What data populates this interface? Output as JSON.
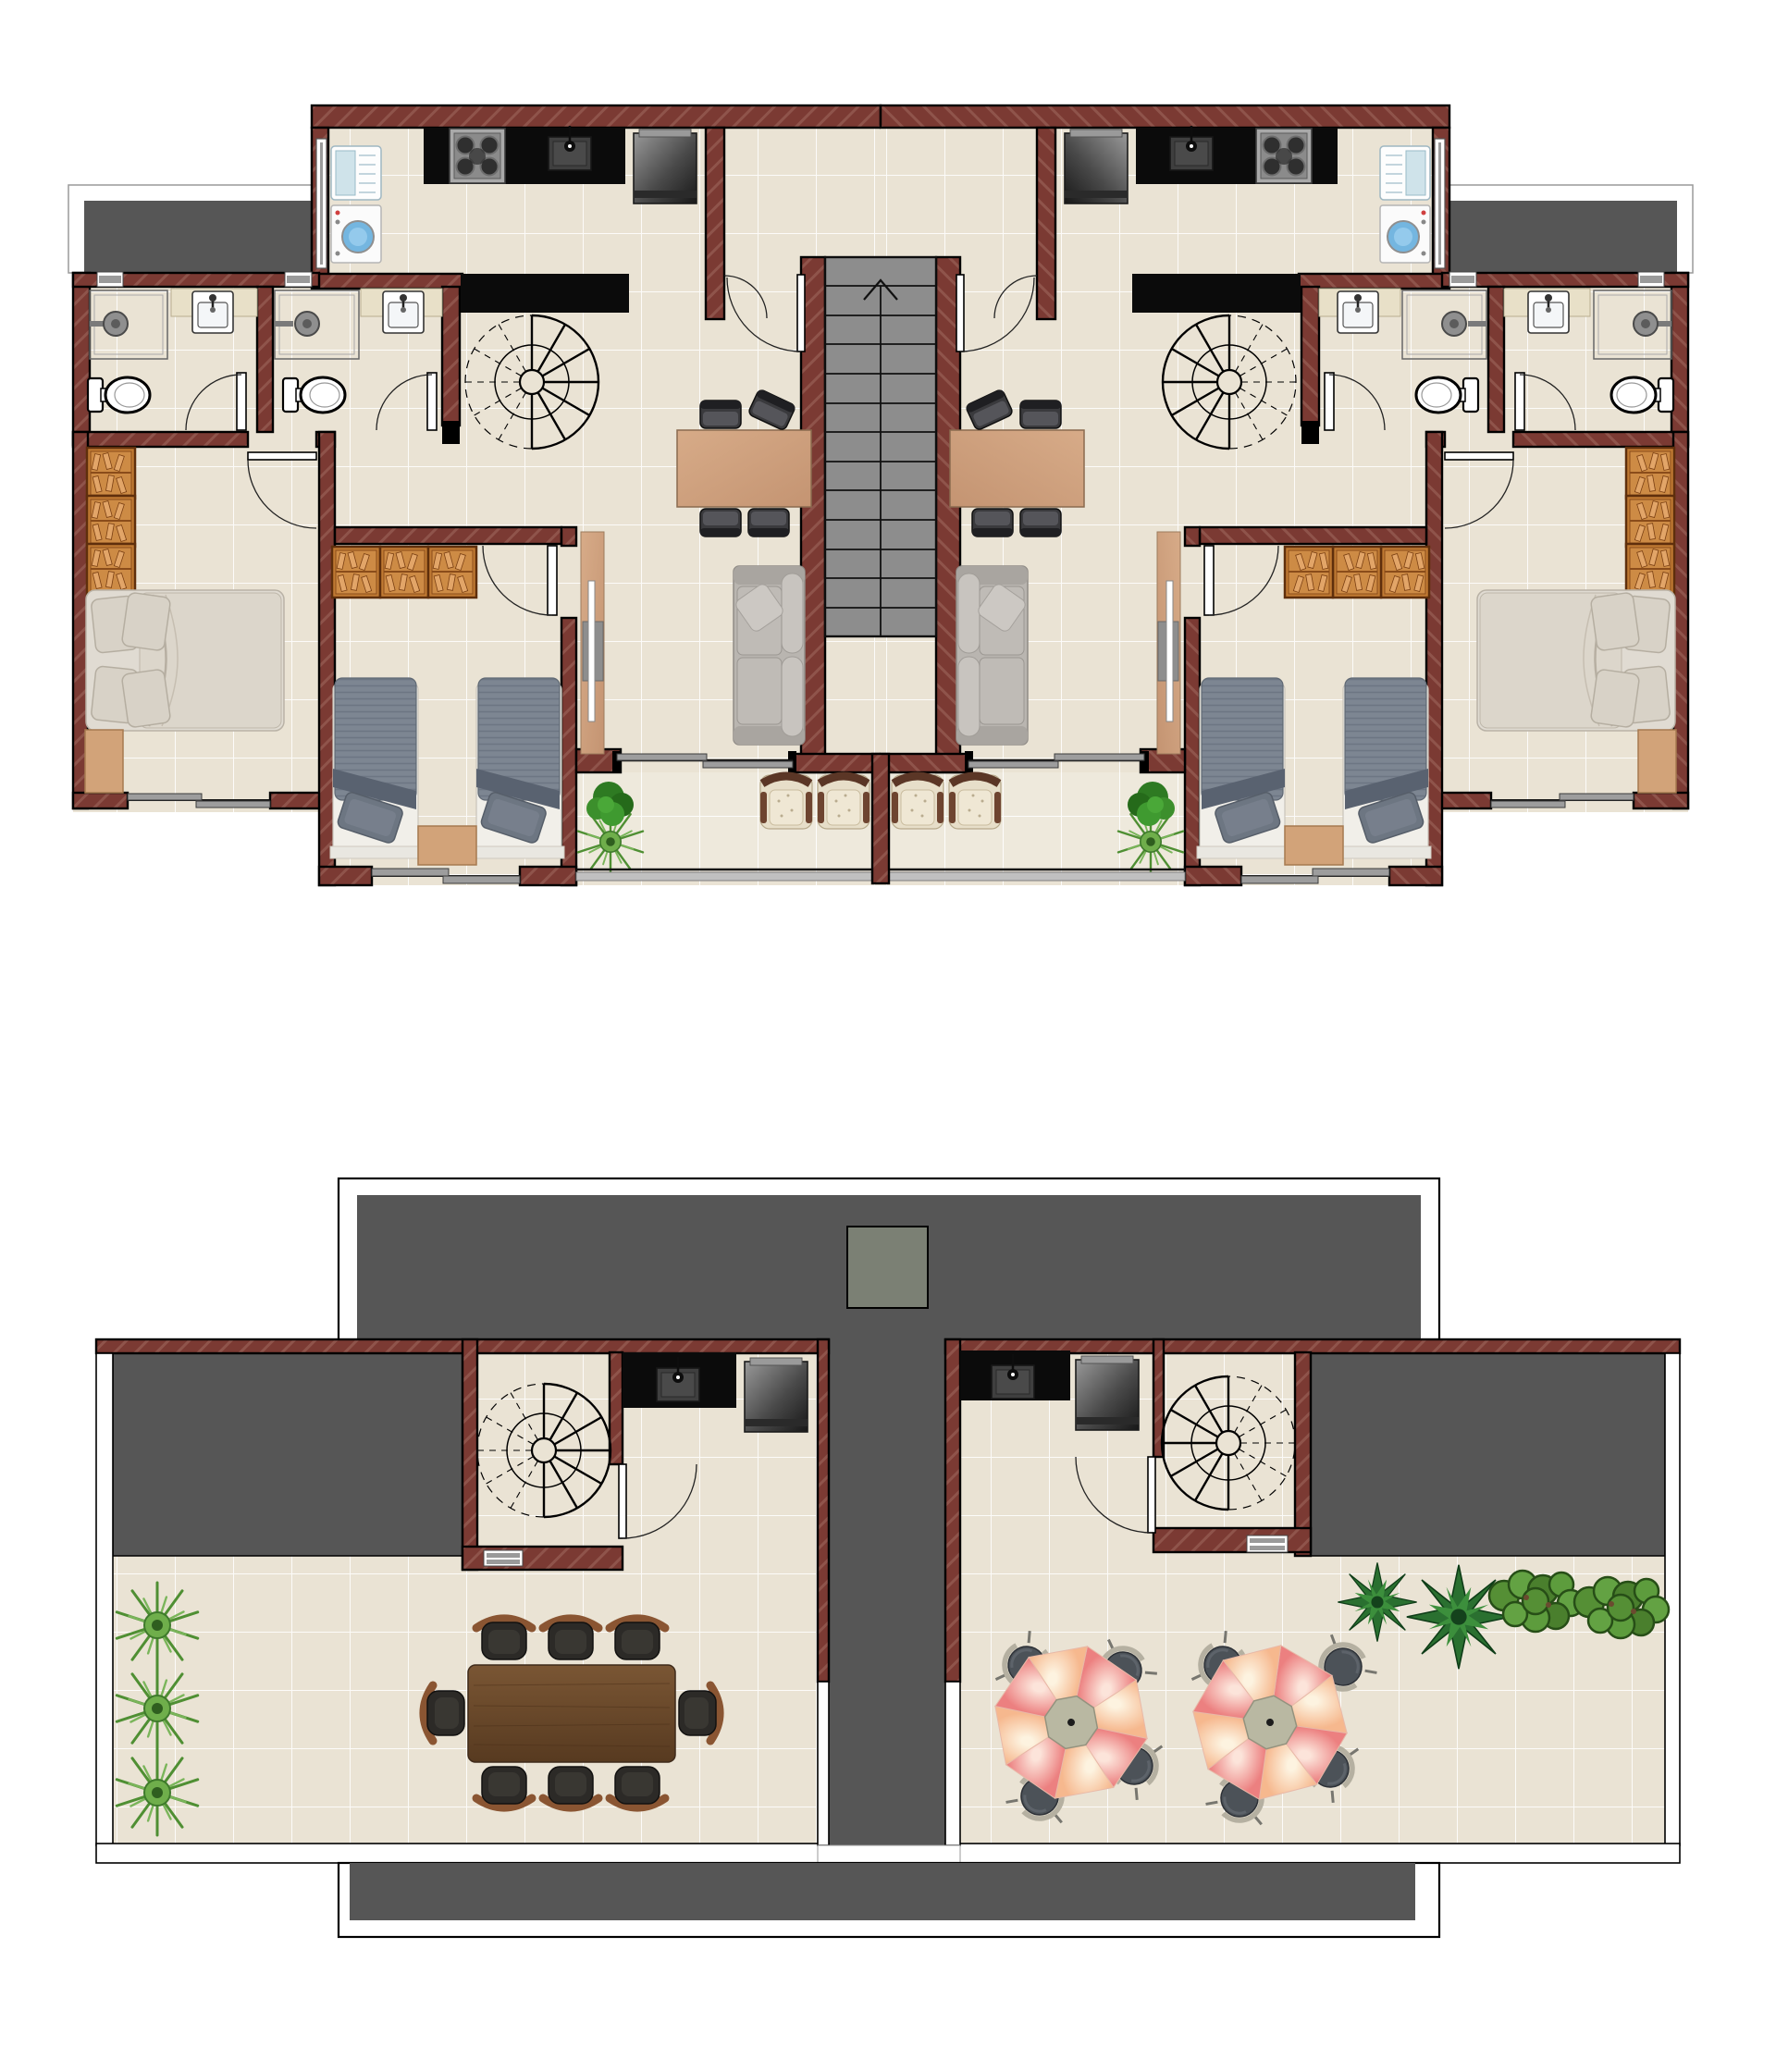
{
  "document": {
    "type": "architectural floor plan",
    "sheets": [
      "upper floor plan",
      "roof terrace plan"
    ],
    "visible_text": [],
    "units": "none shown"
  },
  "palette": {
    "page_bg": "#ffffff",
    "wall": "#7b3a33",
    "wall_hatch": "#a06a5f",
    "floor_tile": "#eae3d4",
    "floor_grout": "#ffffff",
    "balcony_tile": "#eee9dc",
    "roof_dark": "#565656",
    "stair_gray": "#8d8d8d",
    "elevator_gray": "#7b8074",
    "counter_black": "#0b0b0b",
    "wood_light": "#cfa385",
    "wood_dark": "#6d4a2d",
    "wardrobe_wood": "#c07a33",
    "sofa_gray": "#b9b5b0",
    "bed_slate": "#7d8692",
    "armchair_cream": "#e7dec9",
    "umbrella_coral": "#ee8989",
    "umbrella_peach": "#fbd5b7",
    "plant_green": "#4f8f33",
    "washer_drum_blue": "#74b6e0"
  },
  "plans": [
    {
      "name": "upper-floor",
      "layout": "two mirrored apartments around a central straight staircase core",
      "per_apartment_rooms": [
        {
          "room": "kitchen",
          "items": [
            "refrigerator-white",
            "washing-machine",
            "gas-stove-4-burner",
            "kitchen-sink",
            "tall-dark-appliance",
            "black-counter",
            "breakfast-bar"
          ]
        },
        {
          "room": "bathroom-1",
          "items": [
            "toilet",
            "shower-with-glass",
            "vanity-sink",
            "window"
          ]
        },
        {
          "room": "bathroom-2",
          "items": [
            "toilet",
            "shower-with-glass",
            "vanity-sink",
            "window"
          ]
        },
        {
          "room": "living-dining",
          "items": [
            "spiral-staircase",
            "dining-table-4-chairs",
            "sofa-3-seat",
            "tv-sideboard"
          ]
        },
        {
          "room": "master-bedroom",
          "items": [
            "double-bed",
            "wardrobe-3-door",
            "nightstand",
            "sliding-window"
          ]
        },
        {
          "room": "twin-bedroom",
          "items": [
            "single-bed",
            "single-bed",
            "wardrobe-3-door",
            "nightstand",
            "sliding-window"
          ]
        },
        {
          "room": "balcony",
          "items": [
            "armchair",
            "armchair",
            "potted-plant",
            "railing",
            "sliding-door"
          ]
        }
      ],
      "core": {
        "items": [
          "double-flight-staircase",
          "up-arrow",
          "entry-doors",
          "landing"
        ]
      }
    },
    {
      "name": "roof-terrace",
      "layout": "two penthouse stair bulkheads with open terraces, central service core strip and roof slabs",
      "left_terrace": {
        "items": [
          "spiral-staircase-room",
          "kitchenette-counter-sink",
          "barbecue-unit",
          "roof-slab-over-bedrooms",
          "dining-table-8-chairs",
          "spiky-plant",
          "spiky-plant",
          "spiky-plant",
          "parapet"
        ]
      },
      "right_terrace": {
        "items": [
          "kitchenette-counter-sink",
          "barbecue-unit",
          "spiral-staircase-room",
          "roof-slab-over-bedrooms",
          "parasol-table-4-chairs",
          "parasol-table-4-chairs",
          "palm-plant",
          "palm-plant",
          "shrub-row",
          "parapet"
        ]
      },
      "shared": {
        "items": [
          "upper-roof-slab",
          "elevator-overrun",
          "lower-roof-slab",
          "core-roof-strip"
        ]
      }
    }
  ]
}
